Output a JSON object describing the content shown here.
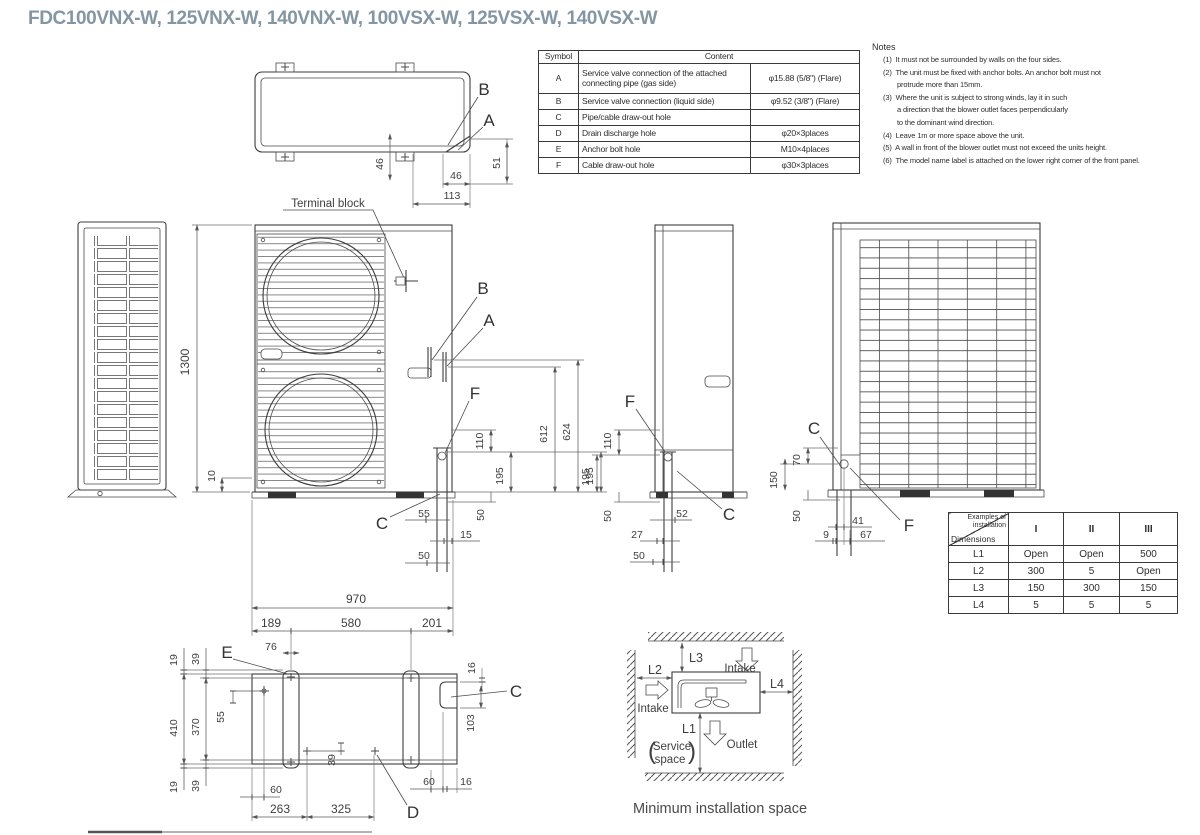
{
  "title": "FDC100VNX-W, 125VNX-W, 140VNX-W, 100VSX-W, 125VSX-W, 140VSX-W",
  "colors": {
    "title_accent": "#8496a3",
    "line": "#3c3c3c"
  },
  "symbol_table": {
    "headers": [
      "Symbol",
      "Content"
    ],
    "rows": [
      {
        "symbol": "A",
        "content": "Service valve connection of the attached connecting pipe (gas side)",
        "value": "φ15.88 (5/8\")  (Flare)"
      },
      {
        "symbol": "B",
        "content": "Service valve connection (liquid side)",
        "value": "φ9.52 (3/8\")  (Flare)"
      },
      {
        "symbol": "C",
        "content": "Pipe/cable draw-out hole",
        "value": ""
      },
      {
        "symbol": "D",
        "content": "Drain discharge hole",
        "value": "φ20×3places"
      },
      {
        "symbol": "E",
        "content": "Anchor bolt hole",
        "value": "M10×4places"
      },
      {
        "symbol": "F",
        "content": "Cable draw-out hole",
        "value": "φ30×3places"
      }
    ]
  },
  "notes": {
    "title": "Notes",
    "items": [
      "(1)  It must not be surrounded by walls on the four sides.",
      "(2)  The unit must be fixed with anchor bolts. An anchor bolt must not\nprotrude more than 15mm.",
      "(3)  Where the unit is subject to strong winds, lay it in such\na direction that the blower outlet faces perpendicularly\nto the dominant wind direction.",
      "(4)  Leave 1m or more space above the unit.",
      "(5)  A wall in front of the blower outlet must not exceed the units height.",
      "(6)  The model name label is attached on the lower right corner of the front panel."
    ]
  },
  "install_table": {
    "corner_top": "Examples of\ninstallation",
    "corner_bottom": "Dimensions",
    "columns": [
      "I",
      "II",
      "III"
    ],
    "rows": [
      {
        "label": "L1",
        "values": [
          "Open",
          "Open",
          "500"
        ]
      },
      {
        "label": "L2",
        "values": [
          "300",
          "5",
          "Open"
        ]
      },
      {
        "label": "L3",
        "values": [
          "150",
          "300",
          "150"
        ]
      },
      {
        "label": "L4",
        "values": [
          "5",
          "5",
          "5"
        ]
      }
    ]
  },
  "top_view": {
    "a": "A",
    "b": "B",
    "terminal": "Terminal block",
    "d46v": "46",
    "d46h": "46",
    "d113": "113",
    "d51": "51"
  },
  "front_view": {
    "a": "A",
    "b": "B",
    "f": "F",
    "c": "C",
    "d1300": "1300",
    "d10": "10",
    "d110": "110",
    "d195": "195",
    "d50v": "50",
    "d55": "55",
    "d15": "15",
    "d50b": "50",
    "d612": "612",
    "d624": "624",
    "d195r": "195",
    "d970": "970"
  },
  "side_view": {
    "f": "F",
    "c": "C",
    "d110": "110",
    "d195": "195",
    "d50v": "50",
    "d52": "52",
    "d27": "27",
    "d50b": "50"
  },
  "back_view": {
    "c": "C",
    "f": "F",
    "d70": "70",
    "d150": "150",
    "d50": "50",
    "d41": "41",
    "d9": "9",
    "d67": "67"
  },
  "bottom_view": {
    "e": "E",
    "c": "C",
    "d": "D",
    "d189": "189",
    "d580": "580",
    "d201": "201",
    "d76": "76",
    "d19t": "19",
    "d39t": "39",
    "d410": "410",
    "d370": "370",
    "d55": "55",
    "d19b": "19",
    "d39b": "39",
    "d16t": "16",
    "d103": "103",
    "d39d": "39",
    "d60l": "60",
    "d263": "263",
    "d325": "325",
    "d60r": "60",
    "d16r": "16"
  },
  "min_space": {
    "l1": "L1",
    "l2": "L2",
    "l3": "L3",
    "l4": "L4",
    "intake_top": "Intake",
    "intake_left": "Intake",
    "outlet": "Outlet",
    "service_open": "(",
    "service_line1": "Service",
    "service_line2": "space",
    "service_close": ")",
    "caption": "Minimum installation space"
  }
}
